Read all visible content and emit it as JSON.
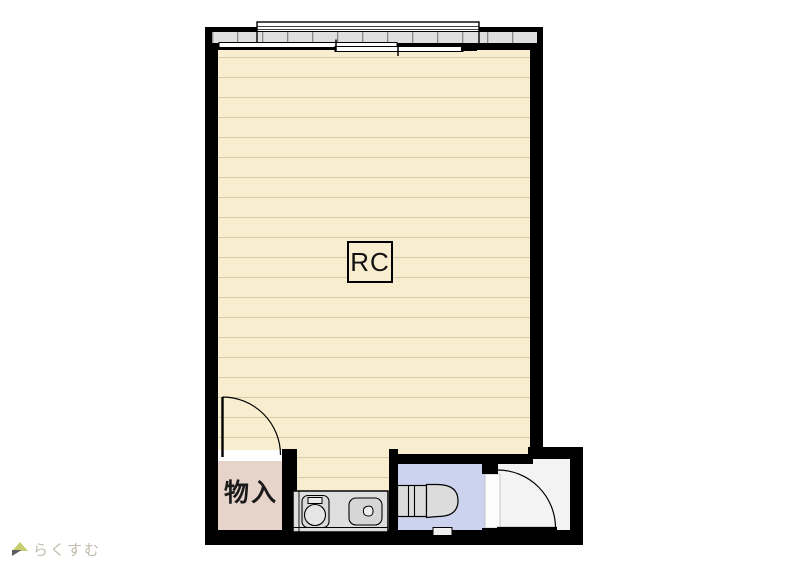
{
  "plan": {
    "structure_label": "RC",
    "rooms": {
      "main": {
        "name": "main-room"
      },
      "storage": {
        "label": "物入"
      },
      "toilet": {
        "name": "toilet-room"
      },
      "entrance": {
        "name": "entrance"
      }
    },
    "fixtures": [
      "balcony-railing",
      "sliding-window",
      "kitchen-counter",
      "stove-burner",
      "sink",
      "toilet"
    ],
    "colors": {
      "wall": "#000000",
      "main_floor": "#f8eecf",
      "floor_line": "#d8cba6",
      "storage_floor": "#e6d3c9",
      "toilet_floor": "#cbd3ee",
      "entrance_floor": "#f3f3f3",
      "fixture_gray": "#dedede",
      "rail_band": "#dfdfdf"
    }
  },
  "watermark": {
    "icon": "house-icon",
    "text": "らくすむ"
  }
}
